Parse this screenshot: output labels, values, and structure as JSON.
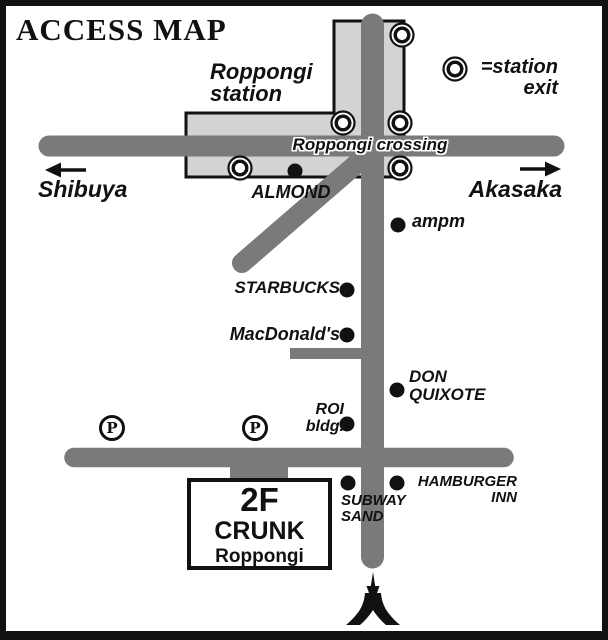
{
  "title": "ACCESS MAP",
  "legend": {
    "station_exit_line1": "=station",
    "station_exit_line2": "exit"
  },
  "station": {
    "name_line1": "Roppongi",
    "name_line2": "station"
  },
  "roads": {
    "crossing_label": "Roppongi crossing",
    "west_label": "Shibuya",
    "east_label": "Akasaka"
  },
  "parking": {
    "symbol": "P"
  },
  "landmarks": {
    "almond": "ALMOND",
    "ampm": "ampm",
    "starbucks": "STARBUCKS",
    "macdonalds": "MacDonald's",
    "don_quixote_line1": "DON",
    "don_quixote_line2": "QUIXOTE",
    "roi_line1": "ROI",
    "roi_line2": "bldg.",
    "subway_line1": "SUBWAY",
    "subway_line2": "SAND",
    "hamburger_line1": "HAMBURGER",
    "hamburger_line2": "INN"
  },
  "destination": {
    "floor": "2F",
    "name": "CRUNK",
    "area": "Roppongi"
  },
  "colors": {
    "road": "#7a7a7a",
    "station_fill": "#d3d3d3",
    "ink": "#111111"
  }
}
